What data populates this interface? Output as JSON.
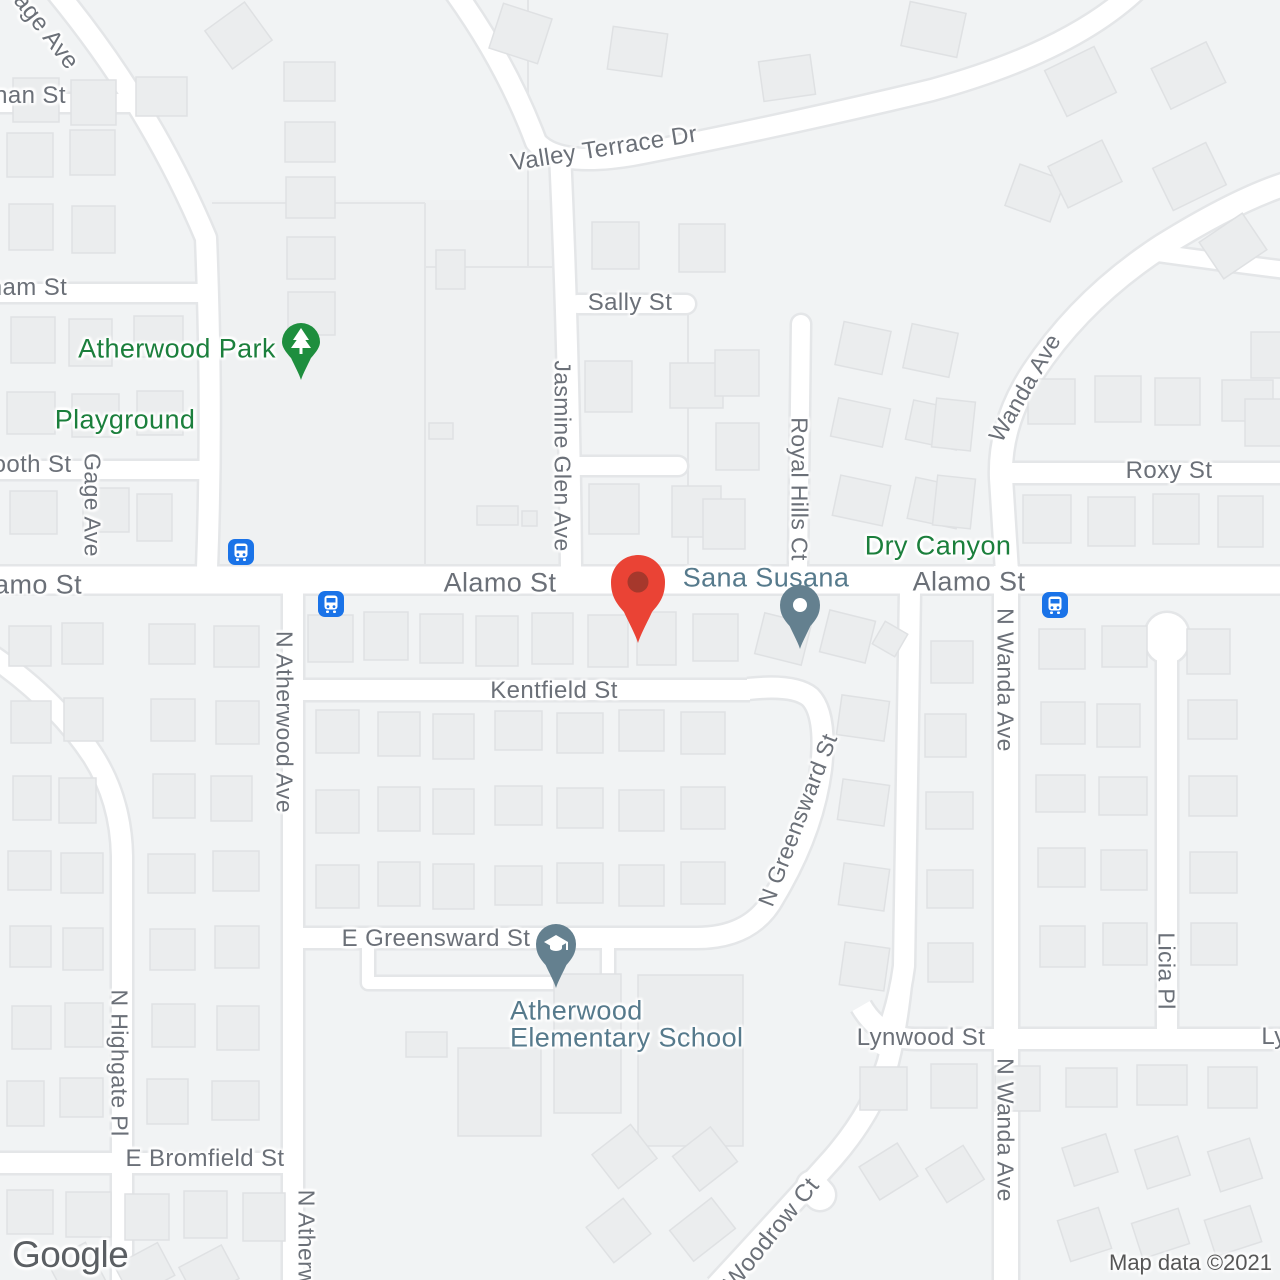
{
  "map": {
    "provider_logo": "Google",
    "attribution": "Map data ©2021",
    "colors": {
      "background": "#f1f3f4",
      "road_fill": "#ffffff",
      "road_casing": "#e4e6e8",
      "building_fill": "#ebedee",
      "street_label": "#6b7078",
      "park_label": "#1b7f3c",
      "poi_label": "#567a8c",
      "destination_pin": "#ea4335",
      "destination_pin_inner": "#a6382c",
      "poi_pin": "#64808f",
      "park_pin": "#1e8e3e",
      "bus_icon": "#1a73e8"
    },
    "street_labels": [
      {
        "text": "Gage Ave",
        "x": 40,
        "y": 24,
        "rot": 52,
        "size": 24
      },
      {
        "text": "nan St",
        "x": 30,
        "y": 96,
        "rot": 0,
        "size": 24
      },
      {
        "text": "ham St",
        "x": 28,
        "y": 288,
        "rot": 0,
        "size": 24
      },
      {
        "text": "ooth St",
        "x": 32,
        "y": 465,
        "rot": 0,
        "size": 24
      },
      {
        "text": "amo St",
        "x": 38,
        "y": 585,
        "rot": 0,
        "size": 27
      },
      {
        "text": "Gage Ave",
        "x": 92,
        "y": 505,
        "rot": 90,
        "size": 23
      },
      {
        "text": "Valley Terrace Dr",
        "x": 604,
        "y": 149,
        "rot": -9,
        "size": 24
      },
      {
        "text": "Sally St",
        "x": 630,
        "y": 303,
        "rot": 0,
        "size": 24
      },
      {
        "text": "Jasmine Glen Ave",
        "x": 562,
        "y": 456,
        "rot": 90,
        "size": 23
      },
      {
        "text": "Royal Hills Ct",
        "x": 799,
        "y": 489,
        "rot": 90,
        "size": 23
      },
      {
        "text": "Roxy St",
        "x": 1169,
        "y": 471,
        "rot": 0,
        "size": 24
      },
      {
        "text": "Wanda Ave",
        "x": 1025,
        "y": 388,
        "rot": -60,
        "size": 23
      },
      {
        "text": "Alamo St",
        "x": 500,
        "y": 583,
        "rot": 0,
        "size": 27
      },
      {
        "text": "Alamo St",
        "x": 969,
        "y": 582,
        "rot": 0,
        "size": 27
      },
      {
        "text": "Kentfield St",
        "x": 554,
        "y": 691,
        "rot": 0,
        "size": 24
      },
      {
        "text": "N Atherwood Ave",
        "x": 284,
        "y": 722,
        "rot": 90,
        "size": 23
      },
      {
        "text": "N Greensward St",
        "x": 798,
        "y": 820,
        "rot": -69,
        "size": 23
      },
      {
        "text": "E Greensward St",
        "x": 436,
        "y": 939,
        "rot": 0,
        "size": 24
      },
      {
        "text": "Lynwood St",
        "x": 921,
        "y": 1038,
        "rot": 0,
        "size": 24
      },
      {
        "text": "Ly",
        "x": 1274,
        "y": 1037,
        "rot": 0,
        "size": 24
      },
      {
        "text": "N Wanda Ave",
        "x": 1005,
        "y": 680,
        "rot": 90,
        "size": 23
      },
      {
        "text": "N Wanda Ave",
        "x": 1005,
        "y": 1130,
        "rot": 90,
        "size": 23
      },
      {
        "text": "Licia Pl",
        "x": 1166,
        "y": 971,
        "rot": 90,
        "size": 23
      },
      {
        "text": "E Bromfield St",
        "x": 205,
        "y": 1159,
        "rot": 0,
        "size": 24
      },
      {
        "text": "N Highgate Pl",
        "x": 119,
        "y": 1063,
        "rot": 90,
        "size": 23
      },
      {
        "text": "N Atherw",
        "x": 306,
        "y": 1238,
        "rot": 90,
        "size": 23
      },
      {
        "text": "Woodrow Ct",
        "x": 772,
        "y": 1234,
        "rot": -51,
        "size": 24
      }
    ],
    "place_labels": [
      {
        "text": "Atherwood Park",
        "x": 177,
        "y": 349,
        "kind": "park",
        "size": 27
      },
      {
        "text": "Playground",
        "x": 125,
        "y": 420,
        "kind": "park",
        "size": 27
      },
      {
        "text": "Dry Canyon",
        "x": 938,
        "y": 546,
        "kind": "park",
        "size": 27
      },
      {
        "text": "Sana Susana",
        "x": 766,
        "y": 578,
        "kind": "poi",
        "size": 27
      },
      {
        "text": "Atherwood",
        "x": 510,
        "y": 1011,
        "kind": "poi",
        "size": 27,
        "align": "left"
      },
      {
        "text": "Elementary School",
        "x": 510,
        "y": 1038,
        "kind": "poi",
        "size": 27,
        "align": "left"
      }
    ],
    "markers": [
      {
        "type": "red-pin",
        "name": "destination-pin",
        "x": 638,
        "y": 643
      },
      {
        "type": "dot-pin",
        "name": "sana-susana-poi-pin",
        "x": 800,
        "y": 649
      },
      {
        "type": "school-pin",
        "name": "school-pin",
        "x": 556,
        "y": 988
      },
      {
        "type": "park-pin",
        "name": "park-tree-pin",
        "x": 301,
        "y": 380
      }
    ],
    "bus_stops": [
      {
        "x": 241,
        "y": 552
      },
      {
        "x": 331,
        "y": 604
      },
      {
        "x": 1055,
        "y": 605
      }
    ]
  }
}
